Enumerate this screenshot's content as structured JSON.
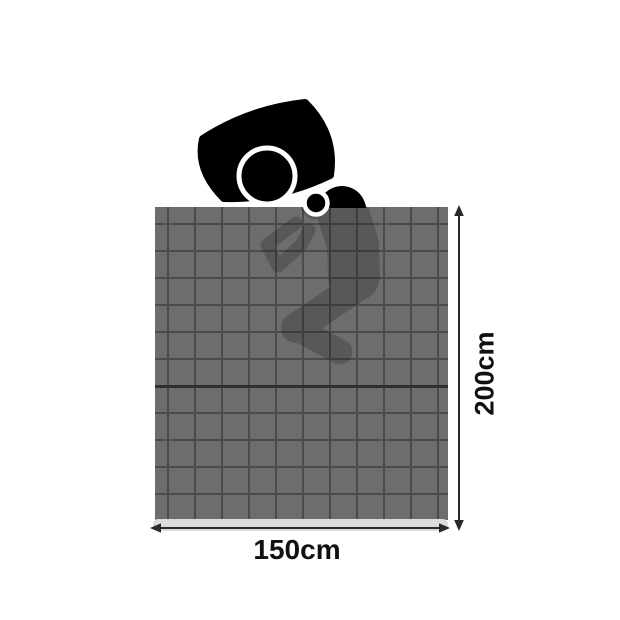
{
  "labels": {
    "height": "200cm",
    "width": "150cm"
  },
  "icons": {
    "pillow": "pillow-icon",
    "person_head": "sleeping-person-head-icon",
    "person_shoulder": "sleeping-person-shoulder-icon",
    "person_body": "sleeping-person-body-silhouette",
    "height_arrow": "vertical-double-arrow-icon",
    "width_arrow": "horizontal-double-arrow-icon"
  },
  "colors": {
    "background": "#ffffff",
    "blanket": "#6d6d6d",
    "grid-line": "#4b4b4b",
    "fold-line": "#303030",
    "figure": "#000000",
    "figure-ring": "#ffffff",
    "shadow-strip": "#dcdcdc",
    "arrow": "#2a2a2a",
    "label-text": "#111111"
  },
  "silhouette_opacity": "0.18"
}
